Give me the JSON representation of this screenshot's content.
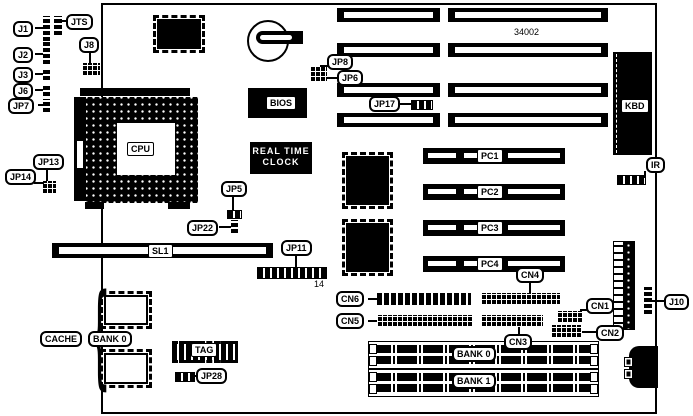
{
  "diagram": {
    "title": "motherboard-layout",
    "board_number": "34002",
    "jp11_pin_count": "14"
  },
  "colors": {
    "background": "#ffffff",
    "ink": "#000000"
  },
  "labels": {
    "j1": "J1",
    "j2": "J2",
    "j3": "J3",
    "j6": "J6",
    "jp7": "JP7",
    "jts": "JTS",
    "j8": "J8",
    "jp13": "JP13",
    "jp14": "JP14",
    "cpu": "CPU",
    "jp5": "JP5",
    "jp22": "JP22",
    "sl1": "SL1",
    "jp11": "JP11",
    "cache": "CACHE",
    "cache_bank0": "BANK 0",
    "tag": "TAG",
    "jp28": "JP28",
    "bios": "BIOS",
    "rtc_line1": "REAL TIME",
    "rtc_line2": "CLOCK",
    "jp8": "JP8",
    "jp6": "JP6",
    "jp17": "JP17",
    "kbd": "KBD",
    "ir": "IR",
    "pc1": "PC1",
    "pc2": "PC2",
    "pc3": "PC3",
    "pc4": "PC4",
    "cn1": "CN1",
    "cn2": "CN2",
    "cn3": "CN3",
    "cn4": "CN4",
    "cn5": "CN5",
    "cn6": "CN6",
    "j10": "J10",
    "simm_bank0": "BANK 0",
    "simm_bank1": "BANK 1"
  }
}
